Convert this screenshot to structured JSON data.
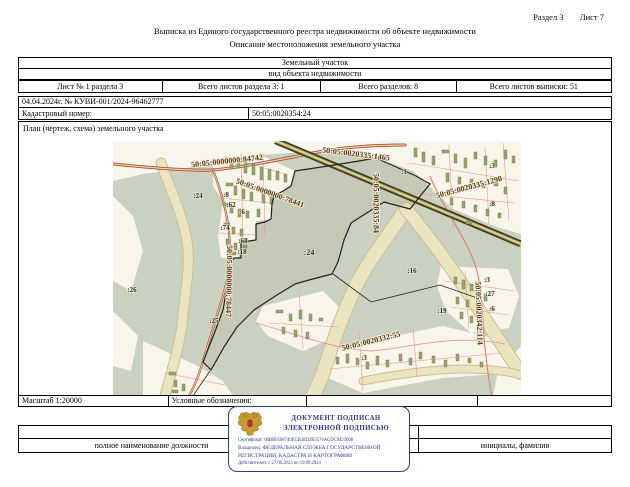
{
  "page": {
    "section": "Раздел 3",
    "sheet": "Лист 7",
    "title": "Выписка из Единого государственного реестра недвижимости об объекте недвижимости",
    "subtitle": "Описание местоположения земельного участка"
  },
  "info": {
    "object_type": "Земельный участок",
    "object_type_caption": "вид объекта недвижимости",
    "sheet_cell": "Лист № 1 раздела 3",
    "section_sheets_cell": "Всего листов раздела 3: 1",
    "sections_total_cell": "Всего разделов: 8",
    "extract_sheets_cell": "Всего листов выписки: 51",
    "date_number": "04.04.2024г. № КУВИ-001/2024-96462777",
    "cadastral_label": "Кадастровый номер:",
    "cadastral_number": "50:05:0020354:24"
  },
  "plan": {
    "caption": "План (чертеж, схема) земельного участка",
    "scale": "Масштаб 1:20000",
    "legend": "Условные обозначения:"
  },
  "map": {
    "labels": [
      {
        "text": "50:05:0000000:84742"
      },
      {
        "text": "50:05:0020335:1465"
      },
      {
        "text": "50:05:0000000:78441"
      },
      {
        "text": "50:05:0020335:1290"
      },
      {
        "text": "50:05:0020335:84"
      },
      {
        "text": "50:05:0000000:78447"
      },
      {
        "text": "50:05:0020342:114"
      },
      {
        "text": "50:05:0020332:55"
      },
      {
        "text": ":24"
      },
      {
        "text": ":8"
      },
      {
        "text": ":62"
      },
      {
        "text": ":6"
      },
      {
        "text": ":74"
      },
      {
        "text": ":68"
      },
      {
        "text": ":18"
      },
      {
        "text": ":24"
      },
      {
        "text": ":26"
      },
      {
        "text": ":25"
      },
      {
        "text": ":16"
      },
      {
        "text": ":19"
      },
      {
        "text": ":1"
      },
      {
        "text": ":3"
      },
      {
        "text": ":8"
      },
      {
        "text": ":3"
      },
      {
        "text": ":27"
      },
      {
        "text": ":6"
      },
      {
        "text": ":3"
      }
    ]
  },
  "signature": {
    "position_label": "полное наименование должности",
    "name_label": "инициалы, фамилия"
  },
  "stamp": {
    "title1": "ДОКУМЕНТ ПОДПИСАН",
    "title2": "ЭЛЕКТРОННОЙ ПОДПИСЬЮ",
    "certificate": "Сертификат: 00BB0568740ECB38D2B3576ACDC9423008",
    "owner_line1": "Владелец: ФЕДЕРАЛЬНАЯ СЛУЖБА ГОСУДАРСТВЕННОЙ",
    "owner_line2": "РЕГИСТРАЦИИ, КАДАСТРА И КАРТОГРАФИИ",
    "validity": "Действителен: с 27.06.2023 по 19.09.2024"
  },
  "colors": {
    "stamp_blue": "#2b3a8f",
    "map_forest": "#cbd1c1",
    "map_settlement": "#f8f5ea",
    "map_wetland": "#eae4c1",
    "map_road_red": "#b4463f",
    "map_label_brown": "#5b3a16"
  }
}
